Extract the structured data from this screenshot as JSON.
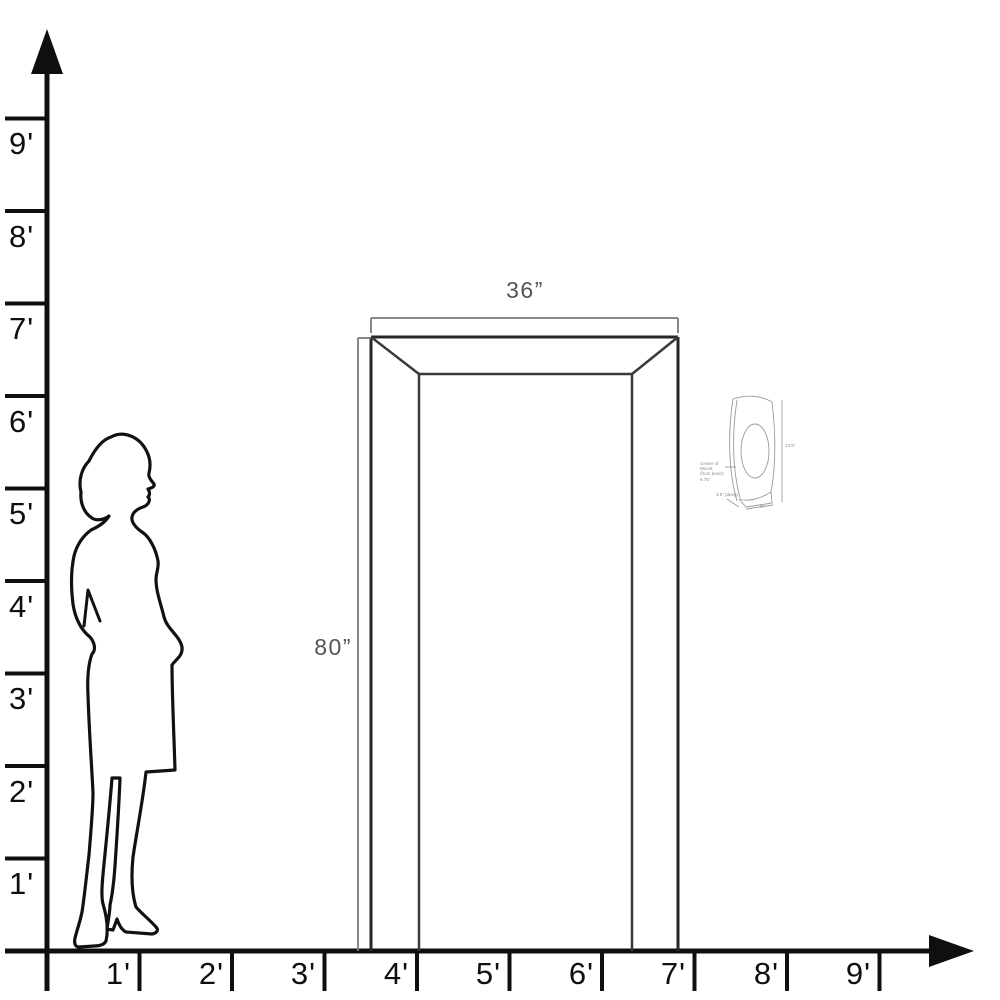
{
  "diagram": {
    "description_labels": {
      "unit": "feet"
    },
    "colors": {
      "axis": "#0f0f0f",
      "door_outer": "#262626",
      "door_inner": "#3a3a3a",
      "dimension_line": "#7a7a7a",
      "dimension_text": "#555555",
      "fixture_line": "#9b9b9b",
      "fixture_text": "#8d8d8d",
      "silhouette": "#111111",
      "background": "#ffffff"
    }
  },
  "axes": {
    "y_labels": [
      "9'",
      "8'",
      "7'",
      "6'",
      "5'",
      "4'",
      "3'",
      "2'",
      "1'"
    ],
    "x_labels": [
      "1'",
      "2'",
      "3'",
      "4'",
      "5'",
      "6'",
      "7'",
      "8'",
      "9'"
    ]
  },
  "door": {
    "width_label": "36”",
    "height_label": "80”"
  },
  "fixture": {
    "mount_line1": "Center of Mount",
    "mount_line2": "(from base): 6.75”",
    "height_label": "13.5”",
    "depth_label": "3.5” (deep)",
    "width_label": "9”"
  },
  "figures": {
    "person": "woman-silhouette",
    "object_left": "doorway-front-view",
    "object_right": "wall-sconce-detail"
  }
}
